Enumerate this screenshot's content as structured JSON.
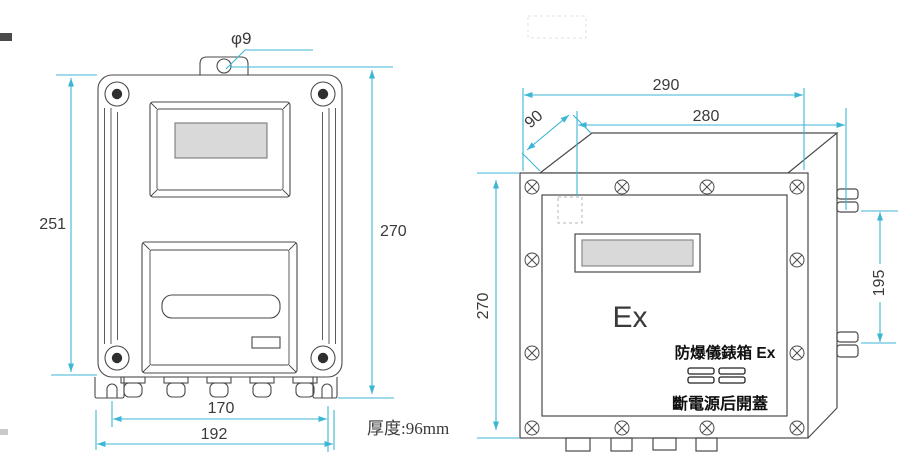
{
  "left_view": {
    "hole_dia": "φ9",
    "dim_body_height": "251",
    "dim_total_height": "270",
    "dim_slot_span": "170",
    "dim_overall_width": "192",
    "thickness_note": "厚度:96mm"
  },
  "right_view": {
    "dim_overall_width": "290",
    "dim_body_width": "280",
    "dim_depth": "90",
    "dim_height": "270",
    "dim_bracket_span": "195",
    "ex_marking": "Ex",
    "plate_line1": "防爆儀錶箱 Ex",
    "plate_line2": "斷電源后開蓋"
  },
  "colors": {
    "dimension_line": "#3db6d6",
    "outline": "#4a4a4a",
    "lcd_fill": "#d9d9d9",
    "label_text": "#3a3a3a"
  }
}
